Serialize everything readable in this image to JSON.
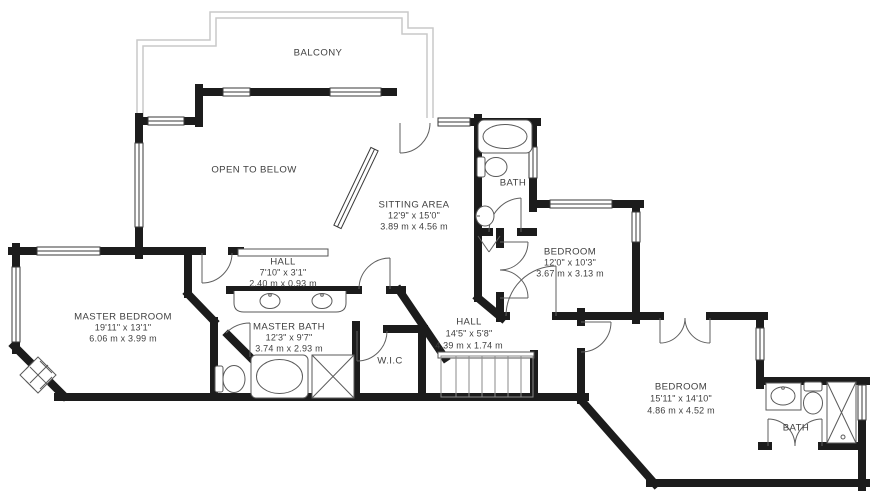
{
  "floorplan": {
    "colors": {
      "background": "#ffffff",
      "wall": "#1c1c1c",
      "thin_line": "#5a5a5a",
      "balcony_line": "#c9c9c9",
      "text": "#404040"
    },
    "areas": {
      "balcony": {
        "label": "BALCONY"
      },
      "open_to_below": {
        "label": "OPEN TO BELOW"
      },
      "sitting_area": {
        "label": "SITTING AREA",
        "imperial": "12'9\" x 15'0\"",
        "metric": "3.89 m x 4.56 m"
      },
      "bath_upper": {
        "label": "BATH"
      },
      "bedroom_right": {
        "label": "BEDROOM",
        "imperial": "12'0\" x 10'3\"",
        "metric": "3.67 m x 3.13 m"
      },
      "hall_upper": {
        "label": "HALL",
        "imperial": "7'10\" x 3'1\"",
        "metric": "2.40 m x 0.93 m"
      },
      "master_bedroom": {
        "label": "MASTER BEDROOM",
        "imperial": "19'11\" x 13'1\"",
        "metric": "6.06 m x 3.99 m"
      },
      "master_bath": {
        "label": "MASTER BATH",
        "imperial": "12'3\" x 9'7\"",
        "metric": "3.74 m x 2.93 m"
      },
      "wic": {
        "label": "W.I.C"
      },
      "hall_lower": {
        "label": "HALL",
        "imperial": "14'5\" x 5'8\"",
        "metric": "4.39 m x 1.74 m"
      },
      "bedroom_lower": {
        "label": "BEDROOM",
        "imperial": "15'11\" x 14'10\"",
        "metric": "4.86 m x 4.52 m"
      },
      "bath_lower": {
        "label": "BATH"
      }
    }
  }
}
